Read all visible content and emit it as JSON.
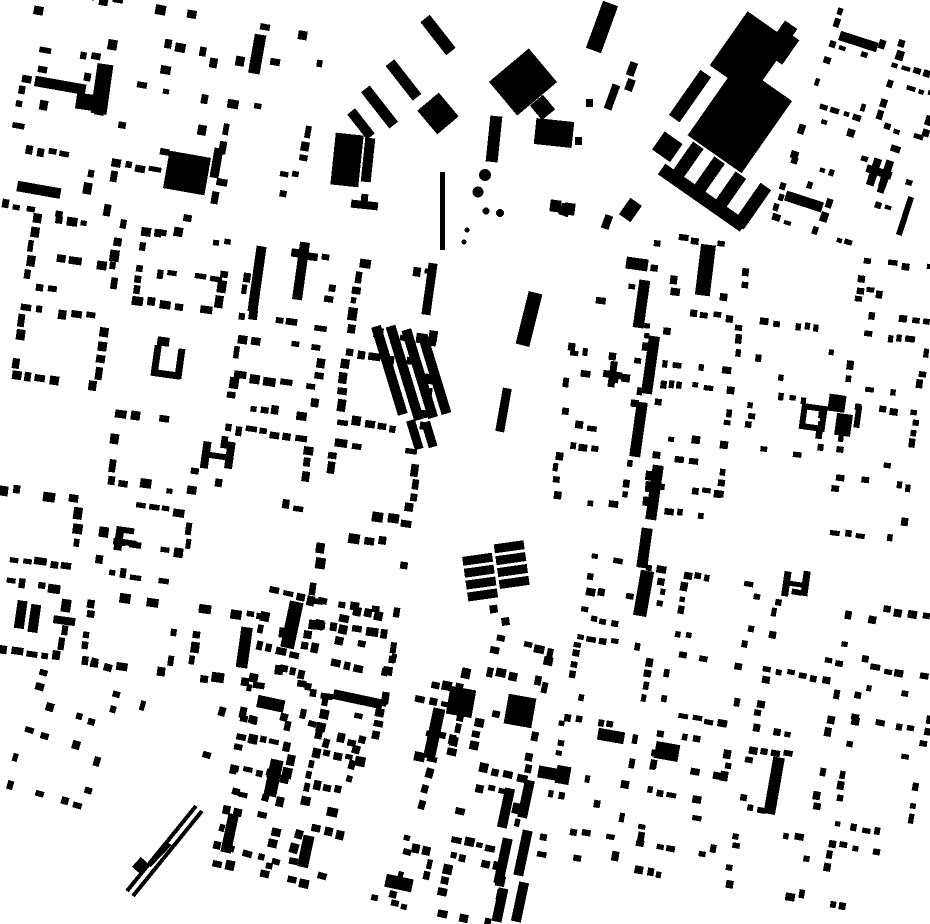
{
  "map": {
    "canvas": {
      "width": 930,
      "height": 924
    },
    "background_color": "#ffffff",
    "building_color": "#000000",
    "corridors": [
      {
        "name": "central-diagonal-corridor",
        "points": [
          [
            448,
            222
          ],
          [
            598,
            222
          ],
          [
            580,
            305
          ],
          [
            548,
            410
          ],
          [
            527,
            505
          ],
          [
            498,
            580
          ],
          [
            458,
            630
          ],
          [
            428,
            700
          ],
          [
            398,
            682
          ],
          [
            412,
            600
          ],
          [
            425,
            500
          ],
          [
            433,
            380
          ],
          [
            438,
            285
          ]
        ]
      },
      {
        "name": "southwest-diagonal-corridor",
        "points": [
          [
            400,
            688
          ],
          [
            430,
            706
          ],
          [
            390,
            810
          ],
          [
            368,
            924
          ],
          [
            324,
            924
          ],
          [
            352,
            802
          ]
        ]
      },
      {
        "name": "southeast-corner-open",
        "points": [
          [
            885,
            830
          ],
          [
            930,
            815
          ],
          [
            930,
            924
          ],
          [
            862,
            924
          ]
        ]
      }
    ],
    "zones": [
      {
        "name": "top-left-fabric",
        "x": 15,
        "y": 8,
        "w": 300,
        "h": 230,
        "rot": 10,
        "bw": 88,
        "bh": 66,
        "sw": 16,
        "sh": 14,
        "minW": 6,
        "maxW": 13,
        "minH": 5,
        "maxH": 10,
        "gapMin": 3,
        "gapMax": 7,
        "pSkip": 0.58,
        "pSlab": 0.3,
        "pEmpty": 0.18,
        "pMid": 0.2,
        "seed": 11
      },
      {
        "name": "west-main-fabric",
        "x": 0,
        "y": 242,
        "w": 448,
        "h": 442,
        "rot": 8,
        "bw": 92,
        "bh": 76,
        "sw": 17,
        "sh": 15,
        "minW": 6,
        "maxW": 13,
        "minH": 5,
        "maxH": 10,
        "gapMin": 2,
        "gapMax": 5,
        "pSkip": 0.4,
        "pSlab": 0.22,
        "pEmpty": 0.1,
        "pMid": 0.3,
        "seed": 22
      },
      {
        "name": "southwest-sparse-fabric",
        "x": 8,
        "y": 700,
        "w": 430,
        "h": 216,
        "rot": 16,
        "bw": 84,
        "bh": 64,
        "sw": 24,
        "sh": 20,
        "minW": 6,
        "maxW": 10,
        "minH": 5,
        "maxH": 9,
        "gapMin": 4,
        "gapMax": 9,
        "pSkip": 0.6,
        "pSlab": 0.06,
        "pEmpty": 0.22,
        "pMid": 0.15,
        "seed": 33
      },
      {
        "name": "south-center-fabric",
        "x": 232,
        "y": 618,
        "w": 332,
        "h": 306,
        "rot": 12,
        "bw": 64,
        "bh": 64,
        "sw": 13,
        "sh": 10,
        "minW": 6,
        "maxW": 11,
        "minH": 5,
        "maxH": 10,
        "gapMin": 2,
        "gapMax": 5,
        "pSkip": 0.38,
        "pSlab": 0.3,
        "pEmpty": 0.08,
        "pMid": 0.35,
        "seed": 44
      },
      {
        "name": "east-main-fabric",
        "x": 562,
        "y": 244,
        "w": 368,
        "h": 334,
        "rot": 7,
        "bw": 78,
        "bh": 60,
        "sw": 15,
        "sh": 13,
        "minW": 5,
        "maxW": 10,
        "minH": 5,
        "maxH": 8,
        "gapMin": 2,
        "gapMax": 6,
        "pSkip": 0.48,
        "pSlab": 0.12,
        "pEmpty": 0.1,
        "pMid": 0.3,
        "seed": 55
      },
      {
        "name": "east-south-fabric",
        "x": 558,
        "y": 584,
        "w": 372,
        "h": 332,
        "rot": 10,
        "bw": 80,
        "bh": 66,
        "sw": 15,
        "sh": 14,
        "minW": 5,
        "maxW": 10,
        "minH": 5,
        "maxH": 8,
        "gapMin": 2,
        "gapMax": 6,
        "pSkip": 0.5,
        "pSlab": 0.12,
        "pEmpty": 0.12,
        "pMid": 0.3,
        "seed": 66
      },
      {
        "name": "northeast-corner-fabric",
        "x": 802,
        "y": 12,
        "w": 126,
        "h": 236,
        "rot": 18,
        "bw": 56,
        "bh": 50,
        "sw": 12,
        "sh": 11,
        "minW": 5,
        "maxW": 10,
        "minH": 4,
        "maxH": 8,
        "gapMin": 2,
        "gapMax": 5,
        "pSkip": 0.5,
        "pSlab": 0.18,
        "pEmpty": 0.15,
        "pMid": 0.2,
        "seed": 77
      }
    ],
    "landmark_groups": [
      {
        "name": "industrial-complex",
        "x": 743,
        "y": -31,
        "rot": 35,
        "parts": [
          [
            28,
            32,
            52,
            66
          ],
          [
            64,
            18,
            15,
            15
          ],
          [
            76,
            26,
            11,
            30
          ],
          [
            50,
            80,
            66,
            88
          ],
          [
            23,
            107,
            13,
            55
          ],
          [
            29,
            178,
            22,
            22
          ],
          [
            58,
            170,
            13,
            34
          ],
          [
            84,
            170,
            13,
            34
          ],
          [
            110,
            170,
            13,
            34
          ],
          [
            48,
            204,
            100,
            13
          ],
          [
            137,
            165,
            13,
            48
          ],
          [
            39,
            252,
            14,
            20
          ]
        ]
      },
      {
        "name": "market-hall-cluster",
        "x": 461,
        "y": 549,
        "rot": -8,
        "parts": [
          [
            0,
            8,
            30,
            9
          ],
          [
            0,
            20,
            30,
            9
          ],
          [
            0,
            32,
            30,
            9
          ],
          [
            0,
            44,
            30,
            9
          ],
          [
            33,
            0,
            30,
            9
          ],
          [
            33,
            12,
            30,
            9
          ],
          [
            33,
            24,
            30,
            9
          ],
          [
            33,
            36,
            30,
            9
          ],
          [
            20,
            60,
            8,
            8
          ],
          [
            30,
            74,
            8,
            8
          ]
        ]
      },
      {
        "name": "courtyard-block-east",
        "x": 804,
        "y": 390,
        "rot": 8,
        "parts": [
          [
            26,
            0,
            17,
            17
          ],
          [
            36,
            18,
            16,
            22
          ],
          [
            54,
            8,
            6,
            22
          ]
        ],
        "rings": [
          [
            0,
            13,
            26,
            26,
            6
          ]
        ]
      },
      {
        "name": "u-building-west",
        "x": 156,
        "y": 336,
        "rot": 8,
        "parts": [
          [
            2,
            0,
            12,
            9
          ],
          [
            0,
            9,
            7,
            30
          ],
          [
            0,
            33,
            30,
            7
          ],
          [
            24,
            9,
            7,
            30
          ]
        ]
      },
      {
        "name": "h-building-west",
        "x": 204,
        "y": 438,
        "rot": 8,
        "parts": [
          [
            0,
            3,
            8,
            27
          ],
          [
            24,
            0,
            8,
            27
          ],
          [
            8,
            13,
            16,
            6
          ]
        ]
      },
      {
        "name": "h-building-east",
        "x": 785,
        "y": 568,
        "rot": 8,
        "parts": [
          [
            0,
            3,
            7,
            25
          ],
          [
            19,
            0,
            7,
            25
          ],
          [
            7,
            12,
            12,
            5
          ]
        ]
      },
      {
        "name": "cross-building-east",
        "x": 605,
        "y": 360,
        "rot": 8,
        "parts": [
          [
            0,
            10,
            19,
            7
          ],
          [
            6,
            0,
            7,
            26
          ]
        ]
      },
      {
        "name": "f-building-west",
        "x": 117,
        "y": 524,
        "rot": 8,
        "parts": [
          [
            0,
            2,
            8,
            24
          ],
          [
            8,
            14,
            14,
            6
          ],
          [
            8,
            2,
            10,
            6
          ]
        ]
      },
      {
        "name": "slab-pair-west",
        "x": 18,
        "y": 598,
        "rot": 8,
        "parts": [
          [
            0,
            2,
            10,
            28
          ],
          [
            14,
            4,
            10,
            28
          ],
          [
            38,
            12,
            22,
            8
          ]
        ]
      },
      {
        "name": "row-bars-center-west",
        "x": 370,
        "y": 324,
        "rot": -17,
        "parts": [
          [
            0,
            4,
            10,
            92
          ],
          [
            14,
            8,
            10,
            98
          ],
          [
            28,
            16,
            10,
            92
          ],
          [
            42,
            26,
            10,
            82
          ],
          [
            6,
            104,
            9,
            30
          ],
          [
            20,
            110,
            9,
            26
          ]
        ]
      }
    ],
    "landmark_rects": [
      {
        "name": "top-center-buildings",
        "items": [
          [
            333,
            134,
            28,
            52,
            6
          ],
          [
            363,
            138,
            10,
            44,
            6
          ],
          [
            432,
            14,
            12,
            42,
            -38
          ],
          [
            398,
            58,
            11,
            44,
            -38
          ],
          [
            374,
            84,
            11,
            46,
            -38
          ],
          [
            356,
            108,
            10,
            32,
            -38
          ],
          [
            497,
            60,
            52,
            44,
            -40
          ],
          [
            534,
            98,
            17,
            19,
            -40
          ],
          [
            424,
            98,
            28,
            31,
            -40
          ],
          [
            535,
            120,
            38,
            26,
            6
          ],
          [
            488,
            116,
            12,
            46,
            6
          ],
          [
            440,
            172,
            5,
            78,
            0
          ],
          [
            351,
            201,
            27,
            8,
            6
          ],
          [
            361,
            194,
            7,
            9,
            6
          ],
          [
            550,
            200,
            11,
            12,
            8
          ],
          [
            564,
            203,
            11,
            12,
            8
          ]
        ]
      },
      {
        "name": "industrial-outbuildings",
        "items": [
          [
            594,
            2,
            16,
            50,
            20
          ],
          [
            608,
            84,
            8,
            26,
            20
          ],
          [
            628,
            62,
            8,
            14,
            20
          ],
          [
            626,
            79,
            8,
            12,
            20
          ],
          [
            586,
            99,
            7,
            8,
            0
          ],
          [
            575,
            137,
            7,
            8,
            0
          ],
          [
            560,
            204,
            10,
            12,
            20
          ],
          [
            603,
            215,
            8,
            14,
            20
          ]
        ]
      },
      {
        "name": "east-main-slab-chain",
        "items": [
          [
            626,
            258,
            22,
            12,
            8
          ],
          [
            636,
            280,
            11,
            48,
            8
          ],
          [
            645,
            336,
            11,
            58,
            8
          ],
          [
            633,
            402,
            11,
            55,
            8
          ],
          [
            649,
            465,
            11,
            55,
            8
          ],
          [
            639,
            528,
            11,
            40,
            8
          ]
        ]
      },
      {
        "name": "west-main-slabs",
        "items": [
          [
            252,
            246,
            10,
            66,
            8
          ],
          [
            296,
            242,
            10,
            58,
            8
          ],
          [
            425,
            263,
            9,
            52,
            8
          ],
          [
            499,
            388,
            9,
            44,
            10
          ],
          [
            522,
            292,
            14,
            54,
            14
          ]
        ]
      },
      {
        "name": "south-center-blocks",
        "items": [
          [
            448,
            688,
            26,
            28,
            10
          ],
          [
            506,
            696,
            28,
            30,
            10
          ],
          [
            538,
            768,
            30,
            12,
            10
          ],
          [
            556,
            766,
            14,
            18,
            10
          ],
          [
            501,
            788,
            10,
            40,
            12
          ],
          [
            498,
            838,
            10,
            46,
            12
          ],
          [
            495,
            888,
            10,
            34,
            12
          ],
          [
            521,
            780,
            10,
            38,
            12
          ],
          [
            518,
            830,
            10,
            46,
            12
          ],
          [
            515,
            882,
            10,
            40,
            12
          ],
          [
            655,
            743,
            24,
            17,
            10
          ]
        ]
      },
      {
        "name": "northeast-cluster",
        "items": [
          [
            866,
            168,
            26,
            8,
            18
          ],
          [
            870,
            158,
            8,
            28,
            18
          ],
          [
            882,
            160,
            8,
            28,
            18
          ],
          [
            902,
            196,
            6,
            40,
            18
          ]
        ]
      },
      {
        "name": "top-left-blocks",
        "items": [
          [
            166,
            154,
            42,
            38,
            10
          ],
          [
            212,
            148,
            9,
            30,
            10
          ],
          [
            94,
            64,
            16,
            50,
            8
          ],
          [
            76,
            94,
            22,
            16,
            8
          ]
        ]
      },
      {
        "name": "railway-shed",
        "items": [
          [
            134,
            860,
            13,
            11,
            -48
          ]
        ]
      }
    ],
    "circles": [
      [
        485,
        175,
        6
      ],
      [
        478,
        192,
        5.5
      ],
      [
        486,
        211,
        3.5
      ],
      [
        500,
        213,
        4
      ],
      [
        467,
        230,
        2.5
      ],
      [
        464,
        242,
        2.5
      ]
    ],
    "railway": {
      "name": "railway-lines",
      "stroke_width": 4,
      "lines": [
        [
          127,
          891,
          196,
          806
        ],
        [
          133,
          896,
          202,
          811
        ],
        [
          149,
          866,
          170,
          844
        ]
      ]
    }
  }
}
